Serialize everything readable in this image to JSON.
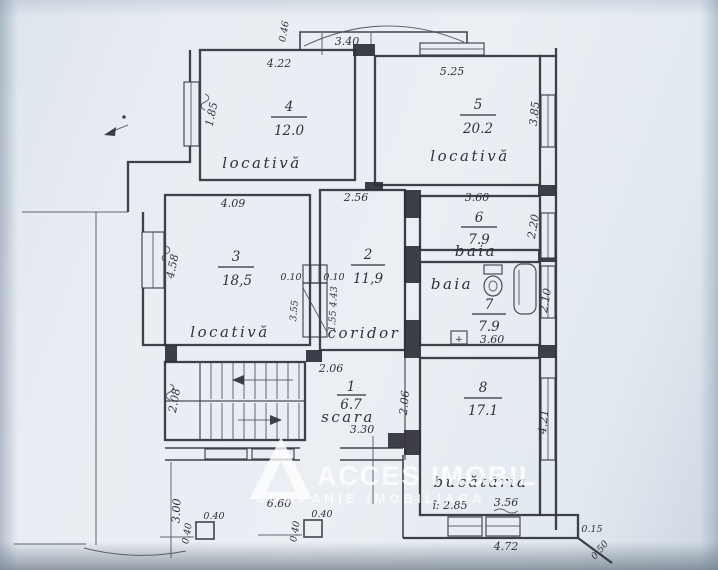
{
  "photo": {
    "type": "scanned hand-drawn apartment floor plan"
  },
  "colors": {
    "paper": "#e9edf3",
    "ink": "#30313a",
    "watermark": "#ffffff"
  },
  "watermark": {
    "brand": "ACCES IMOBIL",
    "tagline": "COMPANIE IMOBILIARA"
  },
  "rooms": {
    "r1": {
      "no": "1",
      "area": "6.7",
      "name": "scara"
    },
    "r2": {
      "no": "2",
      "area": "11,9",
      "name": "coridor"
    },
    "r3": {
      "no": "3",
      "area": "18,5",
      "name": "locativă"
    },
    "r4": {
      "no": "4",
      "area": "12.0",
      "name": "locativă"
    },
    "r5": {
      "no": "5",
      "area": "20.2",
      "name": "locativă"
    },
    "r6": {
      "no": "6",
      "area": "7.9",
      "name": "baia"
    },
    "r7": {
      "no": "7",
      "area": "7.9",
      "name": "baia"
    },
    "r8": {
      "no": "8",
      "area": "17.1",
      "name": "bucătăria"
    }
  },
  "dims": {
    "bump_width": "3.40",
    "bump_depth": "0.46",
    "r4_top": "4.22",
    "r4_left": "1.85",
    "r5_top": "5.25",
    "r5_right": "3.85",
    "r3_top": "4.09",
    "r3_left": "4.58",
    "r2_top": "2.56",
    "shaft_off_left": "0.10",
    "shaft_off_right": "0.10",
    "shaft_h": "3.55",
    "shaft_chain": "1.55 4.43",
    "r6_top": "3.60",
    "r6_right": "2.20",
    "r7_right": "2.10",
    "r7_bottom": "3.60",
    "r7_bottom_prefix": "+",
    "stairs_top": "2.06",
    "stairs_left": "2.08",
    "landing_right": "2.06",
    "stairs_width": "3.30",
    "r8_right": "4.21",
    "r8_bottom": "3.56",
    "r8_height": "î: 2.85",
    "r8_bottom_out": "4.72",
    "porch_span": "6.60",
    "porch_col": "0.40",
    "porch_left": "3.00",
    "edge_right": "0.15",
    "edge_diag": "0.50"
  }
}
